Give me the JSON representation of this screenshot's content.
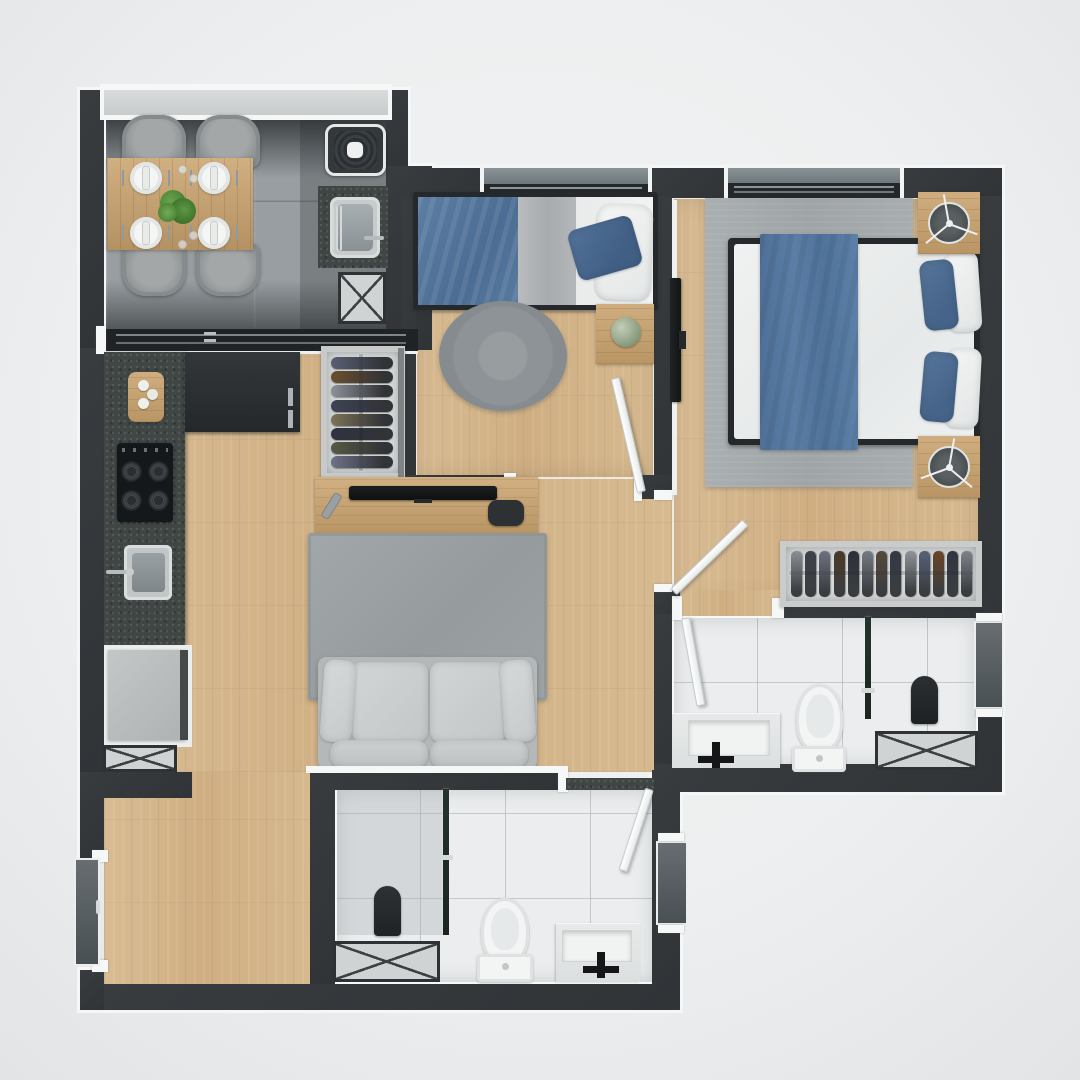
{
  "scene": {
    "title": "Apartment floor plan - top-down 3D render",
    "type": "2-bedroom residential unit, no text labels visible"
  },
  "palette": {
    "background": "#eef0f1",
    "wall": "#34383b",
    "wall_trim_white": "#f5f6f7",
    "wood_floor": "#d5b68c",
    "gray_tile_floor": "#989ea1",
    "white_tile_floor": "#ebedee",
    "granite_counter": "#3f4644",
    "window_sill_stone": "#7d878b",
    "balcony_sill": "#d0d4d4",
    "accent_blue_bedding": "#54779e",
    "sofa_gray": "#cdd0d0",
    "rug_gray": "#9da2a4",
    "furniture_wood": "#c9a26d",
    "glass_partition_green": "#1d2a24",
    "appliance_dark": "#2e3234"
  },
  "rooms": [
    {
      "id": "dining-laundry",
      "floor": "gray-tile",
      "items": [
        "dining-table",
        "chair x4",
        "plate x4",
        "plant-centerpiece",
        "washing-machine",
        "laundry-sink",
        "granite-counter",
        "service-shaft",
        "balcony-window-band",
        "sliding-glass-door"
      ]
    },
    {
      "id": "kitchen-corridor",
      "floor": "wood",
      "items": [
        "granite-counter-run",
        "cutting-board",
        "cooktop-4-burner",
        "kitchen-sink",
        "tall-dark-cabinet",
        "refrigerator",
        "service-shaft"
      ]
    },
    {
      "id": "living-room",
      "floor": "wood",
      "items": [
        "open-wardrobe-with-clothes",
        "tv-console",
        "tv",
        "remote-control",
        "decor-object",
        "area-rug",
        "sofa-2-seat"
      ]
    },
    {
      "id": "bedroom-2",
      "floor": "wood",
      "items": [
        "single-bed-blue-bedding",
        "round-rug",
        "side-table",
        "decor-sphere",
        "window",
        "swing-door"
      ]
    },
    {
      "id": "master-bedroom",
      "floor": "wood",
      "items": [
        "double-bed-blue-runner",
        "area-rug",
        "nightstand x2",
        "table-lamp x2",
        "wall-mounted-tv",
        "wardrobe-clothes-rail",
        "window",
        "swing-door"
      ]
    },
    {
      "id": "ensuite-bathroom",
      "floor": "white-tile",
      "items": [
        "vanity-sink-black-faucet",
        "toilet",
        "glass-shower-partition",
        "shower-seat",
        "ventilation-window",
        "service-shaft",
        "swing-door"
      ]
    },
    {
      "id": "bathroom-2",
      "floor": "white-tile",
      "items": [
        "vanity-sink-black-faucet",
        "toilet",
        "glass-shower-partition",
        "shower-seat",
        "ventilation-window",
        "service-shaft",
        "swing-door",
        "granite-threshold"
      ]
    },
    {
      "id": "entry-hall",
      "floor": "wood",
      "items": [
        "entry-door-slab"
      ]
    }
  ],
  "wardrobes": {
    "living_vertical_rack": {
      "orientation": "horizontal-bundles",
      "colors": [
        "#5a5f77",
        "#6b4f2e",
        "#8d9198",
        "#3e4354",
        "#7d7257",
        "#2e3340",
        "#565a44",
        "#6e7287"
      ]
    },
    "master_horizontal_rack": {
      "orientation": "vertical-bundles",
      "colors": [
        "#8b8f94",
        "#3c414b",
        "#6d7280",
        "#4b3a25",
        "#2b303a",
        "#757a82",
        "#57493a",
        "#333845",
        "#8f9399",
        "#56617a",
        "#6b4526",
        "#2f343f",
        "#7e838a"
      ]
    }
  },
  "counts": {
    "chairs": 4,
    "plates": 4,
    "shafts": 4,
    "doors_swing": 4,
    "bathrooms": 2,
    "bedrooms": 2
  }
}
